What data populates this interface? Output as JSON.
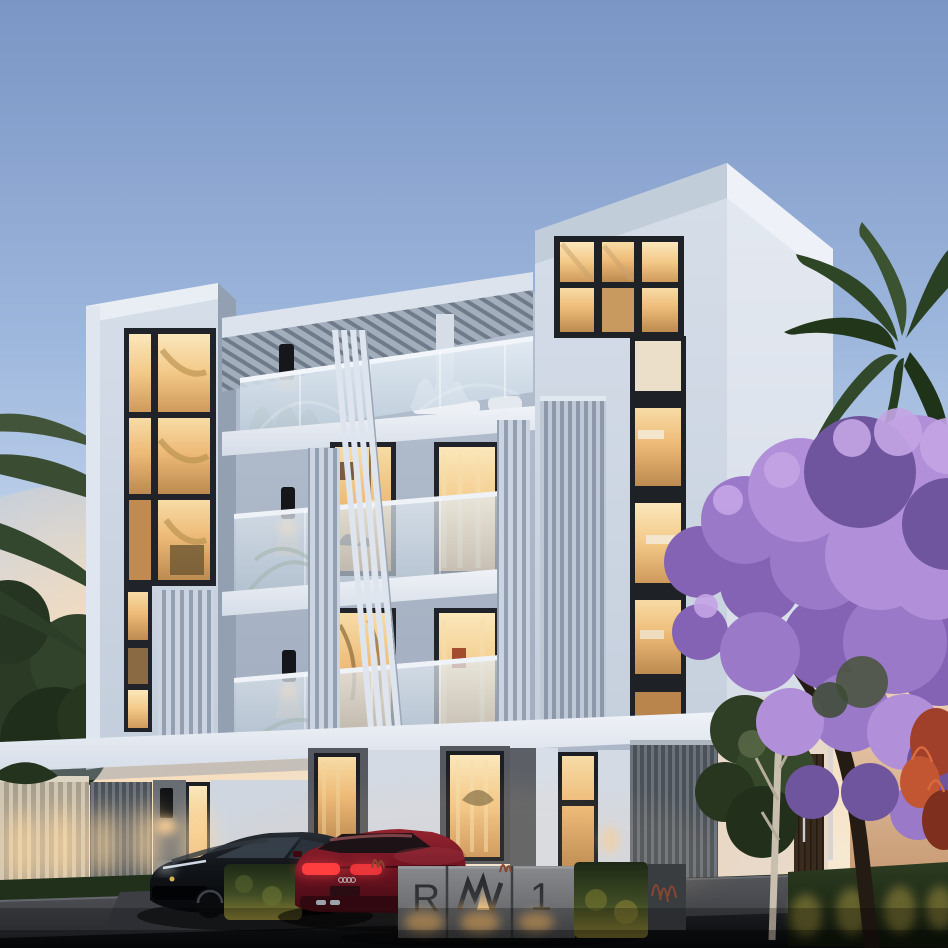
{
  "scene": {
    "title": "RW1 residence dusk exterior rendering",
    "setting": "dusk",
    "building": "modern white four-storey residential building with pergola roof terrace",
    "landscape": [
      "palm trees",
      "jacaranda tree in bloom",
      "clipped lit hedges",
      "lawn strip"
    ],
    "vehicles": [
      "black sports car",
      "dark red coupe"
    ],
    "signage_wall": "backlit concrete entrance wall with project monogram"
  },
  "signage": {
    "letter_left": "R",
    "monogram": "rw-crown-monogram",
    "letter_right": "1"
  },
  "palette": {
    "sky_top": "#7b95c5",
    "sky_horizon": "#f6e9d2",
    "facade_light": "#d6dee9",
    "facade_shadow": "#a9b5c6",
    "window_glow": "#eebb78",
    "pergola_slat": "#6f7b8a",
    "glass_reflection": "#dbe7f1",
    "concrete_sign": "#6e7073",
    "hedge_green": "#2a3820",
    "jacaranda_purple": "#9a79c9",
    "palm_green": "#2e4526",
    "street_asphalt": "#0d0f12",
    "car_red": "#711423",
    "car_black": "#0a0d11",
    "uplight_warm": "#ffd9a0"
  }
}
